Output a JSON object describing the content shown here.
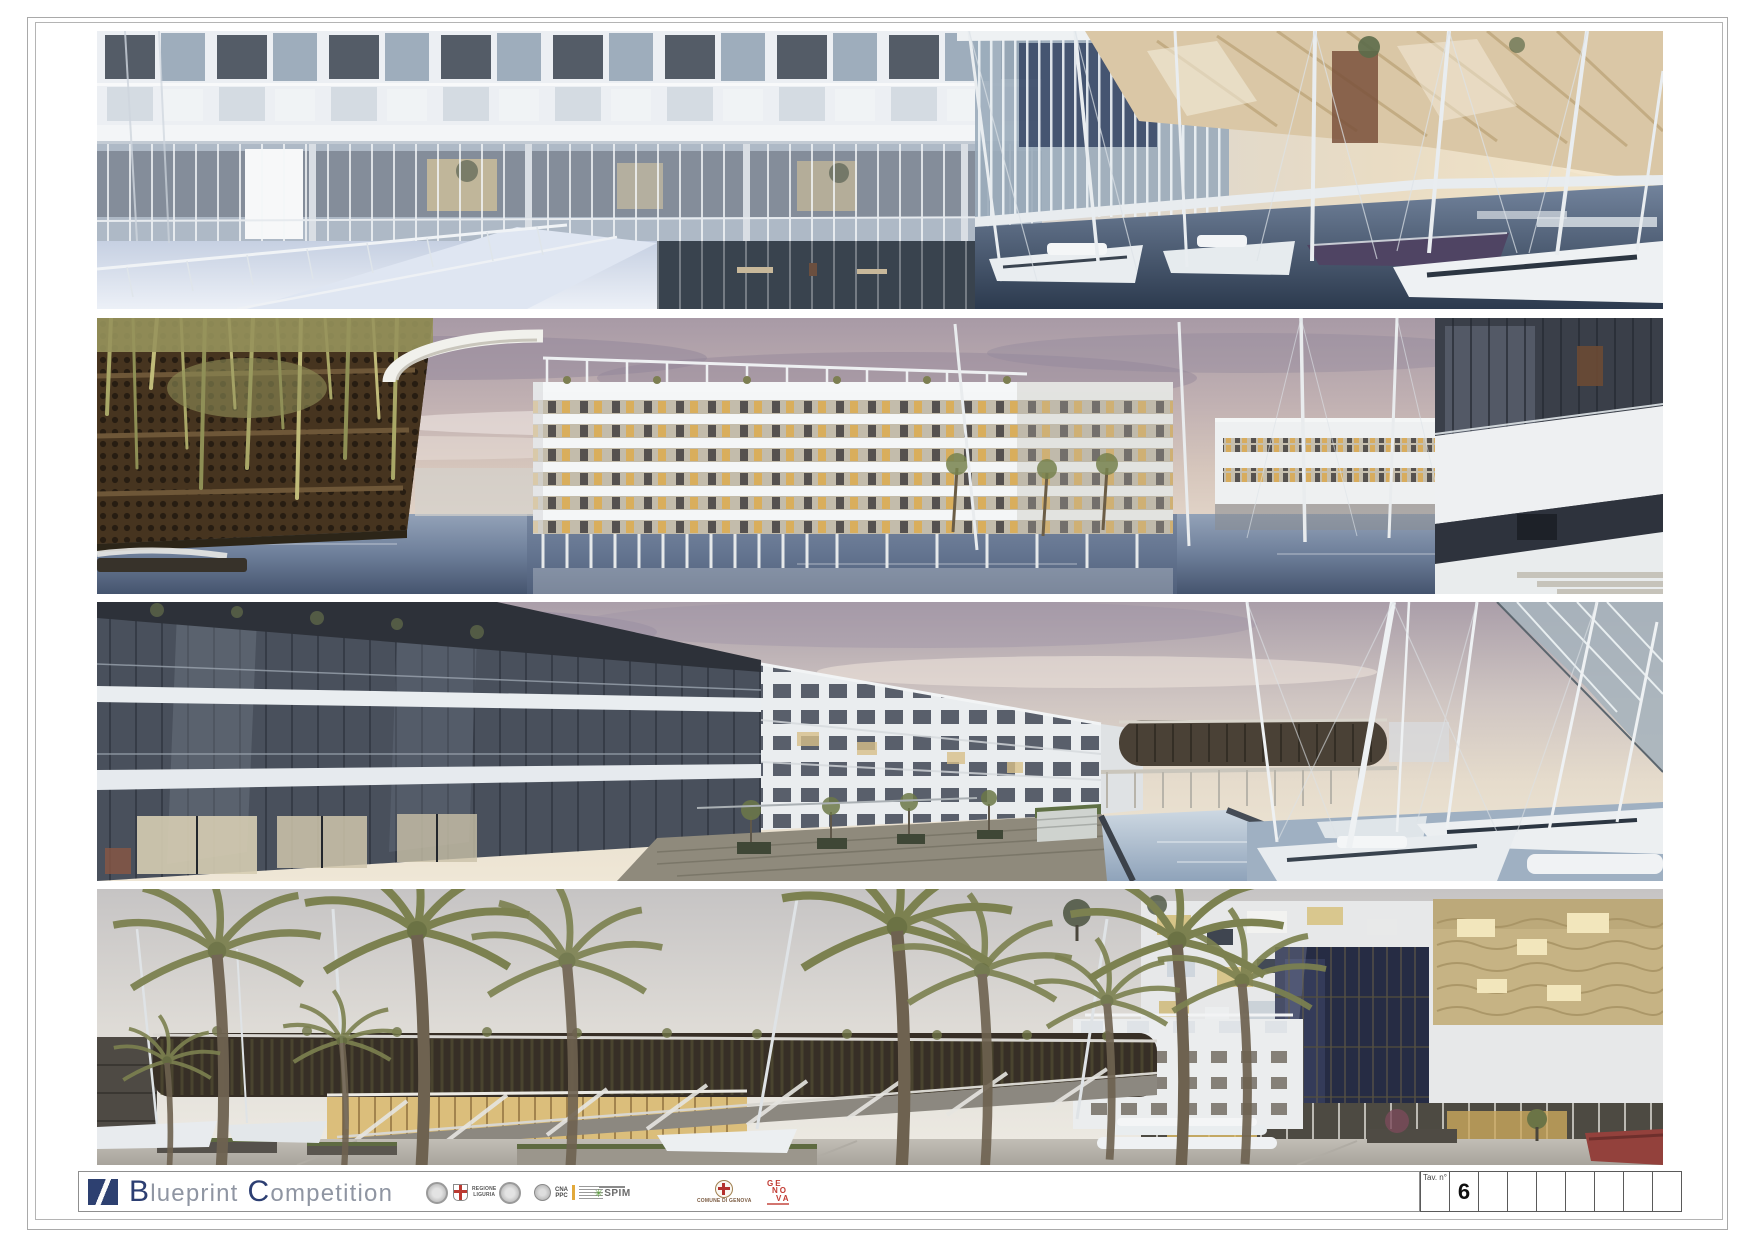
{
  "sheet": {
    "tav_label": "Tav. n°",
    "tav_number": "6"
  },
  "branding": {
    "word1_initial": "B",
    "word1_rest": "lueprint",
    "word2_initial": "C",
    "word2_rest": "ompetition"
  },
  "sponsors": {
    "regione_liguria": {
      "line1": "REGIONE",
      "line2": "LIGURIA"
    },
    "cna_ppc": {
      "line1": "CNA",
      "line2": "PPC"
    },
    "spim": {
      "label": "SPIM"
    },
    "comune_di_genova": {
      "label": "COMUNE DI GENOVA"
    },
    "genova_brand": {
      "line1": "GE",
      "line2": "NO",
      "line3": "VA"
    }
  },
  "renders": [
    {
      "description": "Panoramic render: glazed residential building with checkerboard facade over a reflecting pool walkway, marina with sailboats and sail-shaped timber canopy at right, warm dusk sky"
    },
    {
      "description": "Panoramic render: corten green wall with hanging vines at left, white hotel volume on slender stilts above the water, pink cloudy sky, marina masts, palms and apartment corner at right"
    },
    {
      "description": "Panoramic render: dark glazed apartment facade in close perspective at left, canal promenade with planters and palms, elliptical pavilion in the distance, moored white sailboats at right"
    },
    {
      "description": "Panoramic render: palm-lined waterfront square, long vine-covered pavilion with rising ramp and glowing glass base, white buildings with irregular windows and golden reflective panel, boats on the quay"
    }
  ]
}
